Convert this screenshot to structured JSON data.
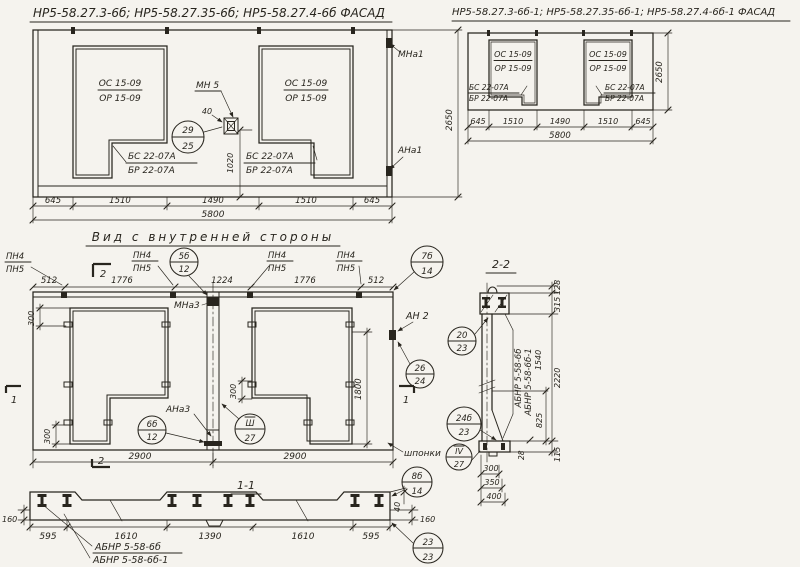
{
  "facade_left": {
    "title": "НР5-58.27.3-6б; НР5-58.27.35-6б; НР5-58.27.4-6б  ФАСАД",
    "window_mark_top": "ОС 15-09",
    "window_mark_bottom": "ОР 15-09",
    "sill_mark_top": "БС 22-07А",
    "sill_mark_bottom": "БР 22-07А",
    "node_label": "МН 5",
    "dim_40": "40",
    "dim_1020": "1020",
    "dim_height": "2650",
    "anchor_top": "МНа1",
    "anchor_bottom": "АНа1",
    "dims_bottom": [
      "645",
      "1510",
      "1490",
      "1510",
      "645"
    ],
    "dim_total": "5800"
  },
  "facade_right": {
    "title": "НР5-58.27.3-6б-1; НР5-58.27.35-6б-1; НР5-58.27.4-6б-1 ФАСАД",
    "window_mark_top": "ОС 15-09",
    "window_mark_bottom": "ОР 15-09",
    "sill_mark_top": "БС 22-07А",
    "sill_mark_bottom": "БР 22-07А",
    "dim_height": "2650",
    "dims_bottom": [
      "645",
      "1510",
      "1490",
      "1510",
      "645"
    ],
    "dim_total": "5800"
  },
  "inner_view": {
    "caption": "Вид с внутренней стороны",
    "pn_top": "ПН4",
    "pn_bottom": "ПН5",
    "dims_top": [
      "512",
      "1776",
      "1224",
      "1776",
      "512"
    ],
    "marker_2": "2",
    "marker_1": "1",
    "node_mna3": "МНа3",
    "node_an2": "АН 2",
    "node_ana3": "АНа3",
    "dim_300": "300",
    "dim_1800": "1800",
    "dims_bottom": [
      "2900",
      "2900"
    ],
    "keys_label": "шпонки"
  },
  "section_1_1": {
    "title": "1-1",
    "dim_160": "160",
    "dim_40": "40",
    "dims_bottom": [
      "595",
      "1610",
      "1390",
      "1610",
      "595"
    ],
    "product_label_1": "АБНР 5-58-6б",
    "product_label_2": "АБНР 5-58-6б-1"
  },
  "section_2_2": {
    "title": "2-2",
    "dims_right": [
      "128",
      "315",
      "2220",
      "115"
    ],
    "dim_825": "825",
    "dim_28": "28",
    "dim_1540": "1540",
    "dims_bottom": [
      "300",
      "350",
      "400"
    ],
    "product_label_1": "АБНР 5-58-6б",
    "product_label_2": "АБНР 5-58-6б-1"
  },
  "callouts": {
    "c29_25": {
      "top": "29",
      "bottom": "25"
    },
    "c5b_12": {
      "top": "5б",
      "bottom": "12"
    },
    "c7b_14": {
      "top": "7б",
      "bottom": "14"
    },
    "c26_24": {
      "top": "26",
      "bottom": "24"
    },
    "c6b_12": {
      "top": "6б",
      "bottom": "12"
    },
    "c3_27": {
      "top": "Ш",
      "bottom": "27"
    },
    "c24b_23": {
      "top": "24б",
      "bottom": "23"
    },
    "c4_27": {
      "top": "IV",
      "bottom": "27"
    },
    "c8b_14": {
      "top": "8б",
      "bottom": "14"
    },
    "c23_23": {
      "top": "23",
      "bottom": "23"
    },
    "c20_23": {
      "top": "20",
      "bottom": "23"
    }
  }
}
